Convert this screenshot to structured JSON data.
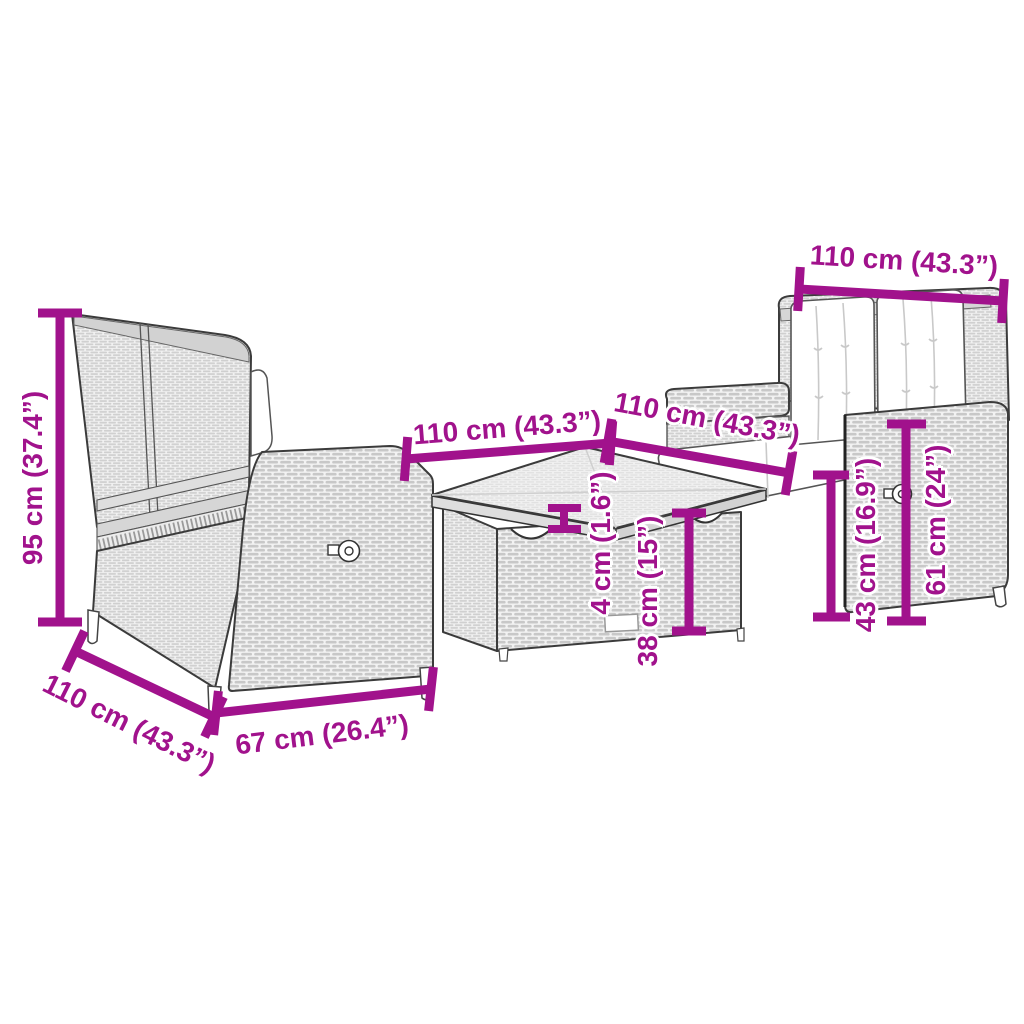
{
  "colors": {
    "accent": "#A1128C",
    "furniture_outline": "#3b3b3b",
    "rattan_fill": "#e9e9e9",
    "cushion_fill": "#ffffff"
  },
  "dimensions": {
    "bench_height": "95 cm (37.4”)",
    "bench_depth": "110 cm (43.3”)",
    "bench_width": "67 cm (26.4”)",
    "table_width": "110 cm (43.3”)",
    "table_top_thickness": "4 cm (1.6”)",
    "table_height": "38 cm (15”)",
    "sofa_depth": "110 cm (43.3”)",
    "sofa_width": "110 cm (43.3”)",
    "sofa_arm_height": "43 cm (16.9”)",
    "sofa_seatback_height": "61 cm (24”)"
  }
}
